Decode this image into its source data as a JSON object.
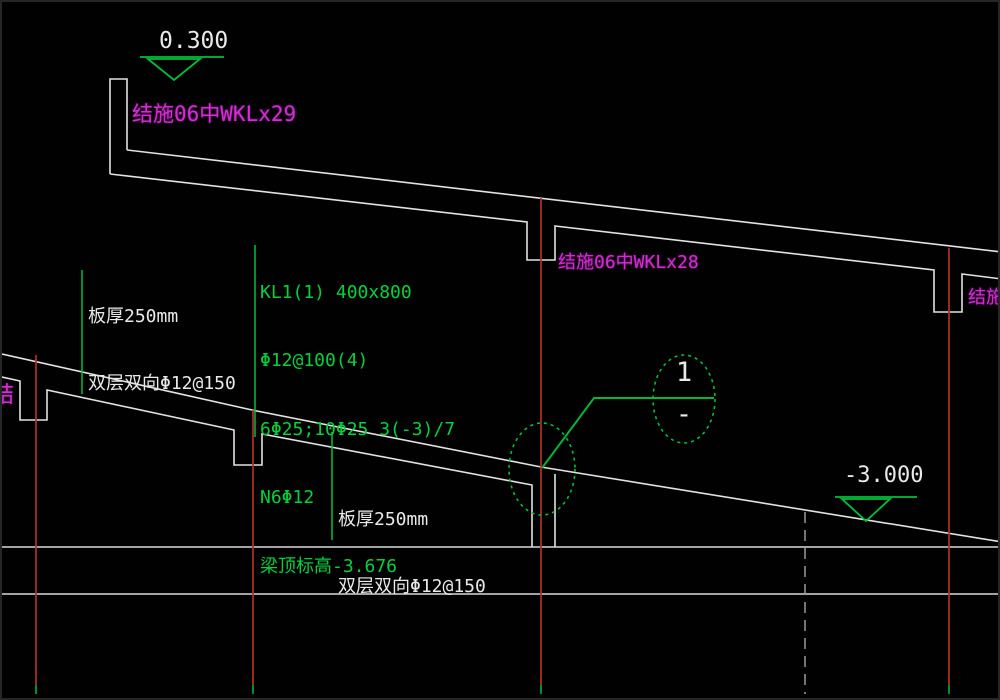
{
  "drawing": {
    "type": "structural-ramp-section",
    "background": "#010101",
    "colors": {
      "outline_white": "#e2e2e2",
      "grid_red": "#b02f2f",
      "grid_dashed_gray": "#9a9a9a",
      "annotation_green": "#00c03a",
      "text_green": "#00d23e",
      "text_magenta": "#cf2fcf",
      "text_white": "#e9e9e9"
    },
    "elevation_markers": {
      "upper": {
        "value": "0.300"
      },
      "lower": {
        "value": "-3.000"
      }
    },
    "beam_refs": {
      "top": {
        "text": "结施06中WKLx29"
      },
      "middle": {
        "text": "结施06中WKLx28"
      },
      "right_clipped": {
        "text": "结施0"
      },
      "left_clipped": {
        "text": "结"
      }
    },
    "beam_note": {
      "lines": [
        "KL1(1) 400x800",
        "Φ12@100(4)",
        "6Φ25;10Φ25 3(-3)/7",
        "N6Φ12",
        "梁顶标高-3.676"
      ]
    },
    "slab_notes": {
      "upper": {
        "line1": "板厚250mm",
        "line2": "双层双向Φ12@150"
      },
      "lower": {
        "line1": "板厚250mm",
        "line2": "双层双向Φ12@150"
      }
    },
    "section_bubble": {
      "number": "1",
      "sheet": "-"
    }
  }
}
